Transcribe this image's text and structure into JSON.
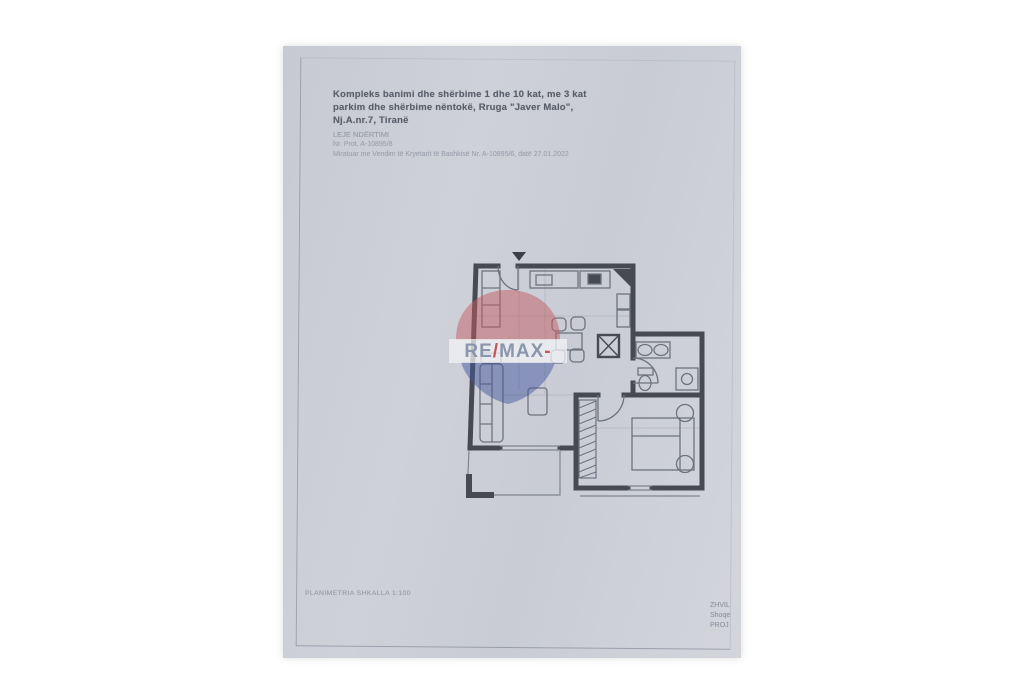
{
  "document": {
    "title_block": {
      "line1": "Kompleks banimi dhe shërbime 1 dhe 10 kat, me 3 kat",
      "line2": "parkim dhe shërbime nëntokë, Rruga \"Javer Malo\",",
      "line3": "Nj.A.nr.7, Tiranë",
      "permit_type": "LEJE NDËRTIMI",
      "protocol_no": "Nr. Prot. A-10895/8",
      "approval": "Miratuar me Vendim të Kryetarit të Bashkisë Nr. A-10895/6, datë 27.01.2022"
    },
    "footer": {
      "scale_note": "PLANIMETRIA SHKALLA 1:100"
    },
    "stamp": {
      "line1": "ZHVIL",
      "line2": "Shoqe",
      "line3": "PROJ"
    },
    "watermark": {
      "brand_re": "RE",
      "brand_slash": "/",
      "brand_max": "MAX",
      "red": "#c25b60",
      "blue": "#46589e"
    },
    "colors": {
      "paper": "#cdd0d8",
      "wall": "#474a52",
      "thin_line": "#80848f"
    }
  }
}
